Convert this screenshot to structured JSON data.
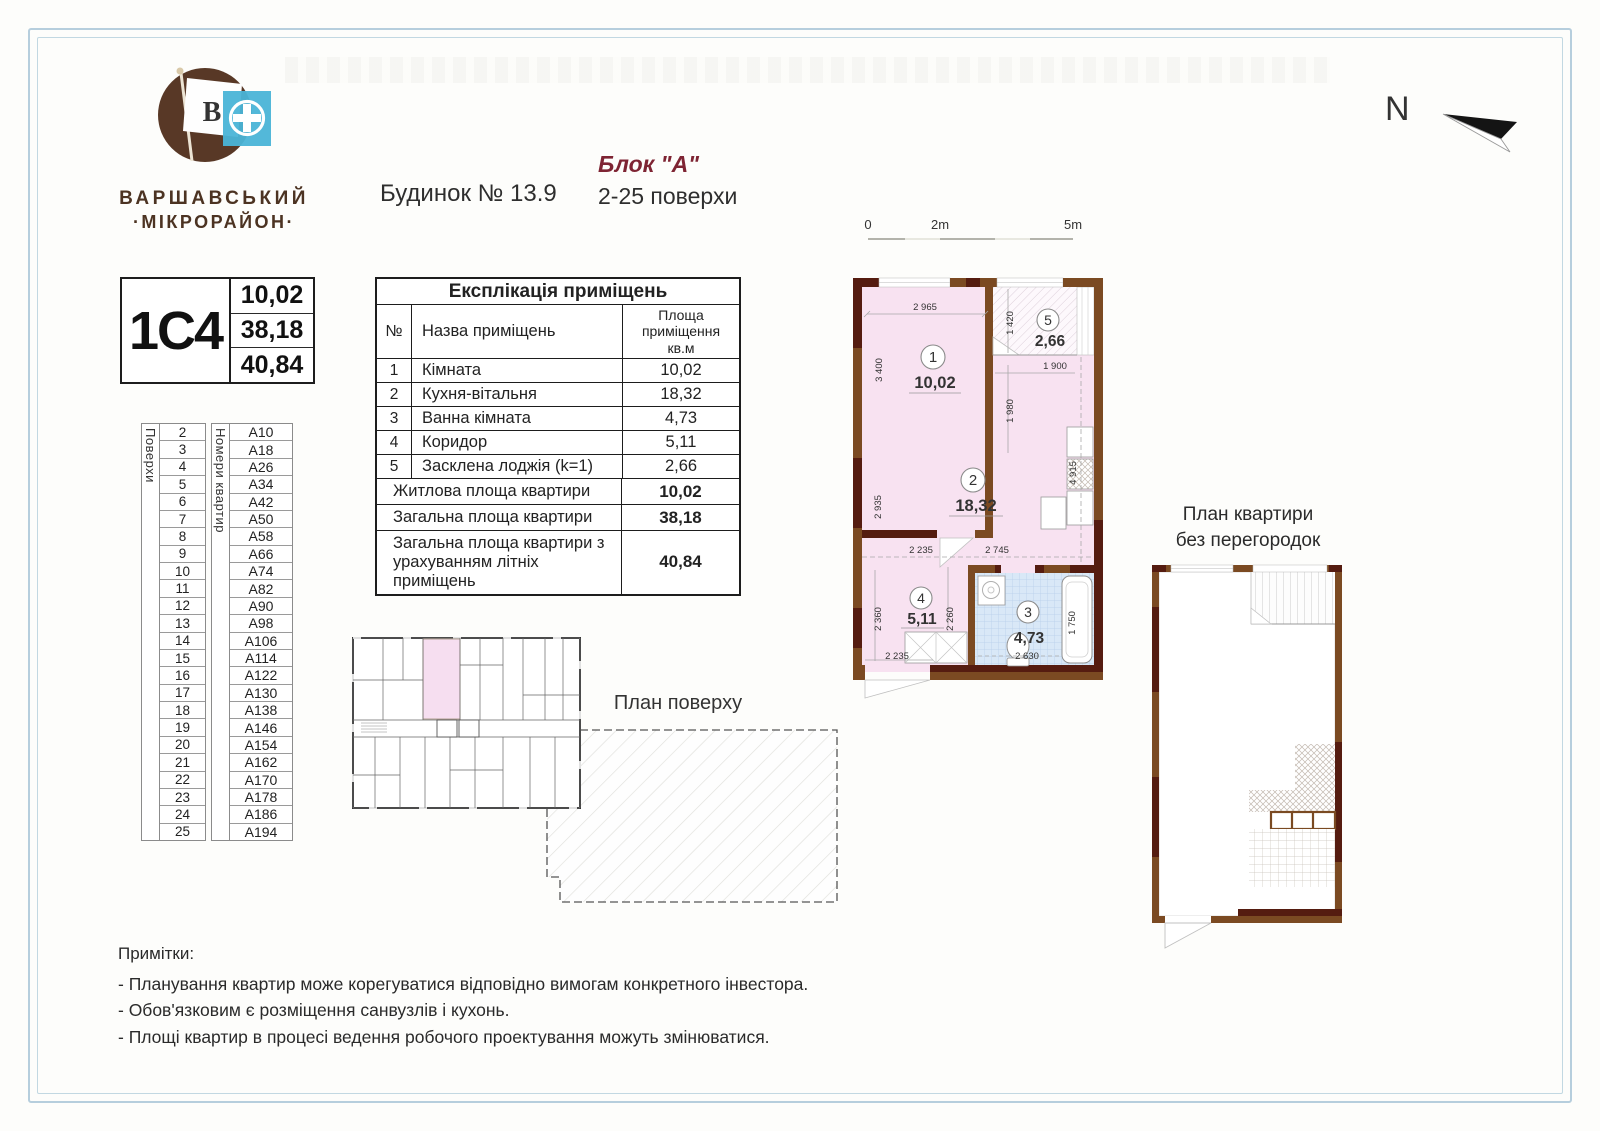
{
  "logo": {
    "flag_letter": "В",
    "brand_line1": "ВАРШАВСЬКИЙ",
    "brand_line2": "·МІКРОРАЙОН·"
  },
  "header": {
    "building": "Будинок № 13.9",
    "block": "Блок \"А\"",
    "floors_range": "2-25 поверхи",
    "north_label": "N"
  },
  "unit_card": {
    "code": "1С4",
    "values": [
      "10,02",
      "38,18",
      "40,84"
    ]
  },
  "floors_table": {
    "floors_label": "Поверхи",
    "apartments_label": "Номери квартир",
    "rows": [
      {
        "floor": "2",
        "apt": "A10"
      },
      {
        "floor": "3",
        "apt": "A18"
      },
      {
        "floor": "4",
        "apt": "A26"
      },
      {
        "floor": "5",
        "apt": "A34"
      },
      {
        "floor": "6",
        "apt": "A42"
      },
      {
        "floor": "7",
        "apt": "A50"
      },
      {
        "floor": "8",
        "apt": "A58"
      },
      {
        "floor": "9",
        "apt": "A66"
      },
      {
        "floor": "10",
        "apt": "A74"
      },
      {
        "floor": "11",
        "apt": "A82"
      },
      {
        "floor": "12",
        "apt": "A90"
      },
      {
        "floor": "13",
        "apt": "A98"
      },
      {
        "floor": "14",
        "apt": "A106"
      },
      {
        "floor": "15",
        "apt": "A114"
      },
      {
        "floor": "16",
        "apt": "A122"
      },
      {
        "floor": "17",
        "apt": "A130"
      },
      {
        "floor": "18",
        "apt": "A138"
      },
      {
        "floor": "19",
        "apt": "A146"
      },
      {
        "floor": "20",
        "apt": "A154"
      },
      {
        "floor": "21",
        "apt": "A162"
      },
      {
        "floor": "22",
        "apt": "A170"
      },
      {
        "floor": "23",
        "apt": "A178"
      },
      {
        "floor": "24",
        "apt": "A186"
      },
      {
        "floor": "25",
        "apt": "A194"
      }
    ]
  },
  "explication": {
    "title": "Експлікація приміщень",
    "col_num": "№",
    "col_name": "Назва приміщень",
    "col_area_l1": "Площа",
    "col_area_l2": "приміщення",
    "col_area_l3": "кв.м",
    "rows": [
      {
        "num": "1",
        "name": "Кімната",
        "area": "10,02"
      },
      {
        "num": "2",
        "name": "Кухня-вітальня",
        "area": "18,32"
      },
      {
        "num": "3",
        "name": "Ванна кімната",
        "area": "4,73"
      },
      {
        "num": "4",
        "name": "Коридор",
        "area": "5,11"
      },
      {
        "num": "5",
        "name": "Засклена лоджія (k=1)",
        "area": "2,66"
      }
    ],
    "summary": [
      {
        "label": "Житлова площа квартири",
        "value": "10,02"
      },
      {
        "label": "Загальна площа квартири",
        "value": "38,18"
      },
      {
        "label": "Загальна площа квартири з урахуванням літніх приміщень",
        "value": "40,84"
      }
    ]
  },
  "scale_bar": {
    "tick0": "0",
    "tick2": "2m",
    "tick5": "5m"
  },
  "apartment_plan": {
    "rooms": [
      {
        "num": "1",
        "area": "10,02"
      },
      {
        "num": "2",
        "area": "18,32"
      },
      {
        "num": "3",
        "area": "4,73"
      },
      {
        "num": "4",
        "area": "5,11"
      },
      {
        "num": "5",
        "area": "2,66"
      }
    ],
    "dims": {
      "top": "2 965",
      "room1_left": "3 400",
      "loggia_height": "1 420",
      "loggia_width": "1 900",
      "hall_height": "1 980",
      "right_height": "4 915",
      "room2_left": "2 935",
      "room4_top": "2 235",
      "bath_top": "2 745",
      "room4_left": "2 360",
      "room4_height": "2 260",
      "bath_right": "1 750",
      "bath_bottom": "2 630",
      "bottom_left": "2 235"
    }
  },
  "floor_plan": {
    "label": "План поверху"
  },
  "no_partitions_plan": {
    "label_line1": "План квартири",
    "label_line2": "без перегородок"
  },
  "notes": {
    "title": "Примітки:",
    "items": [
      "- Планування квартир може корегуватися відповідно вимогам конкретного інвестора.",
      "- Обов'язковим є розміщення санвузлів і кухонь.",
      "- Площі квартир в процесі ведення  робочого проектування  можуть змінюватися."
    ]
  },
  "colors": {
    "wall_brown": "#7b4a22",
    "wall_maroon": "#551c10",
    "room_pink": "#f8e2f1",
    "bath_blue": "#d9e8f7",
    "accent_red": "#7e2433",
    "logo_brown": "#583826",
    "logo_blue": "#4ab4d7",
    "frame_blue": "#b6cedd"
  }
}
